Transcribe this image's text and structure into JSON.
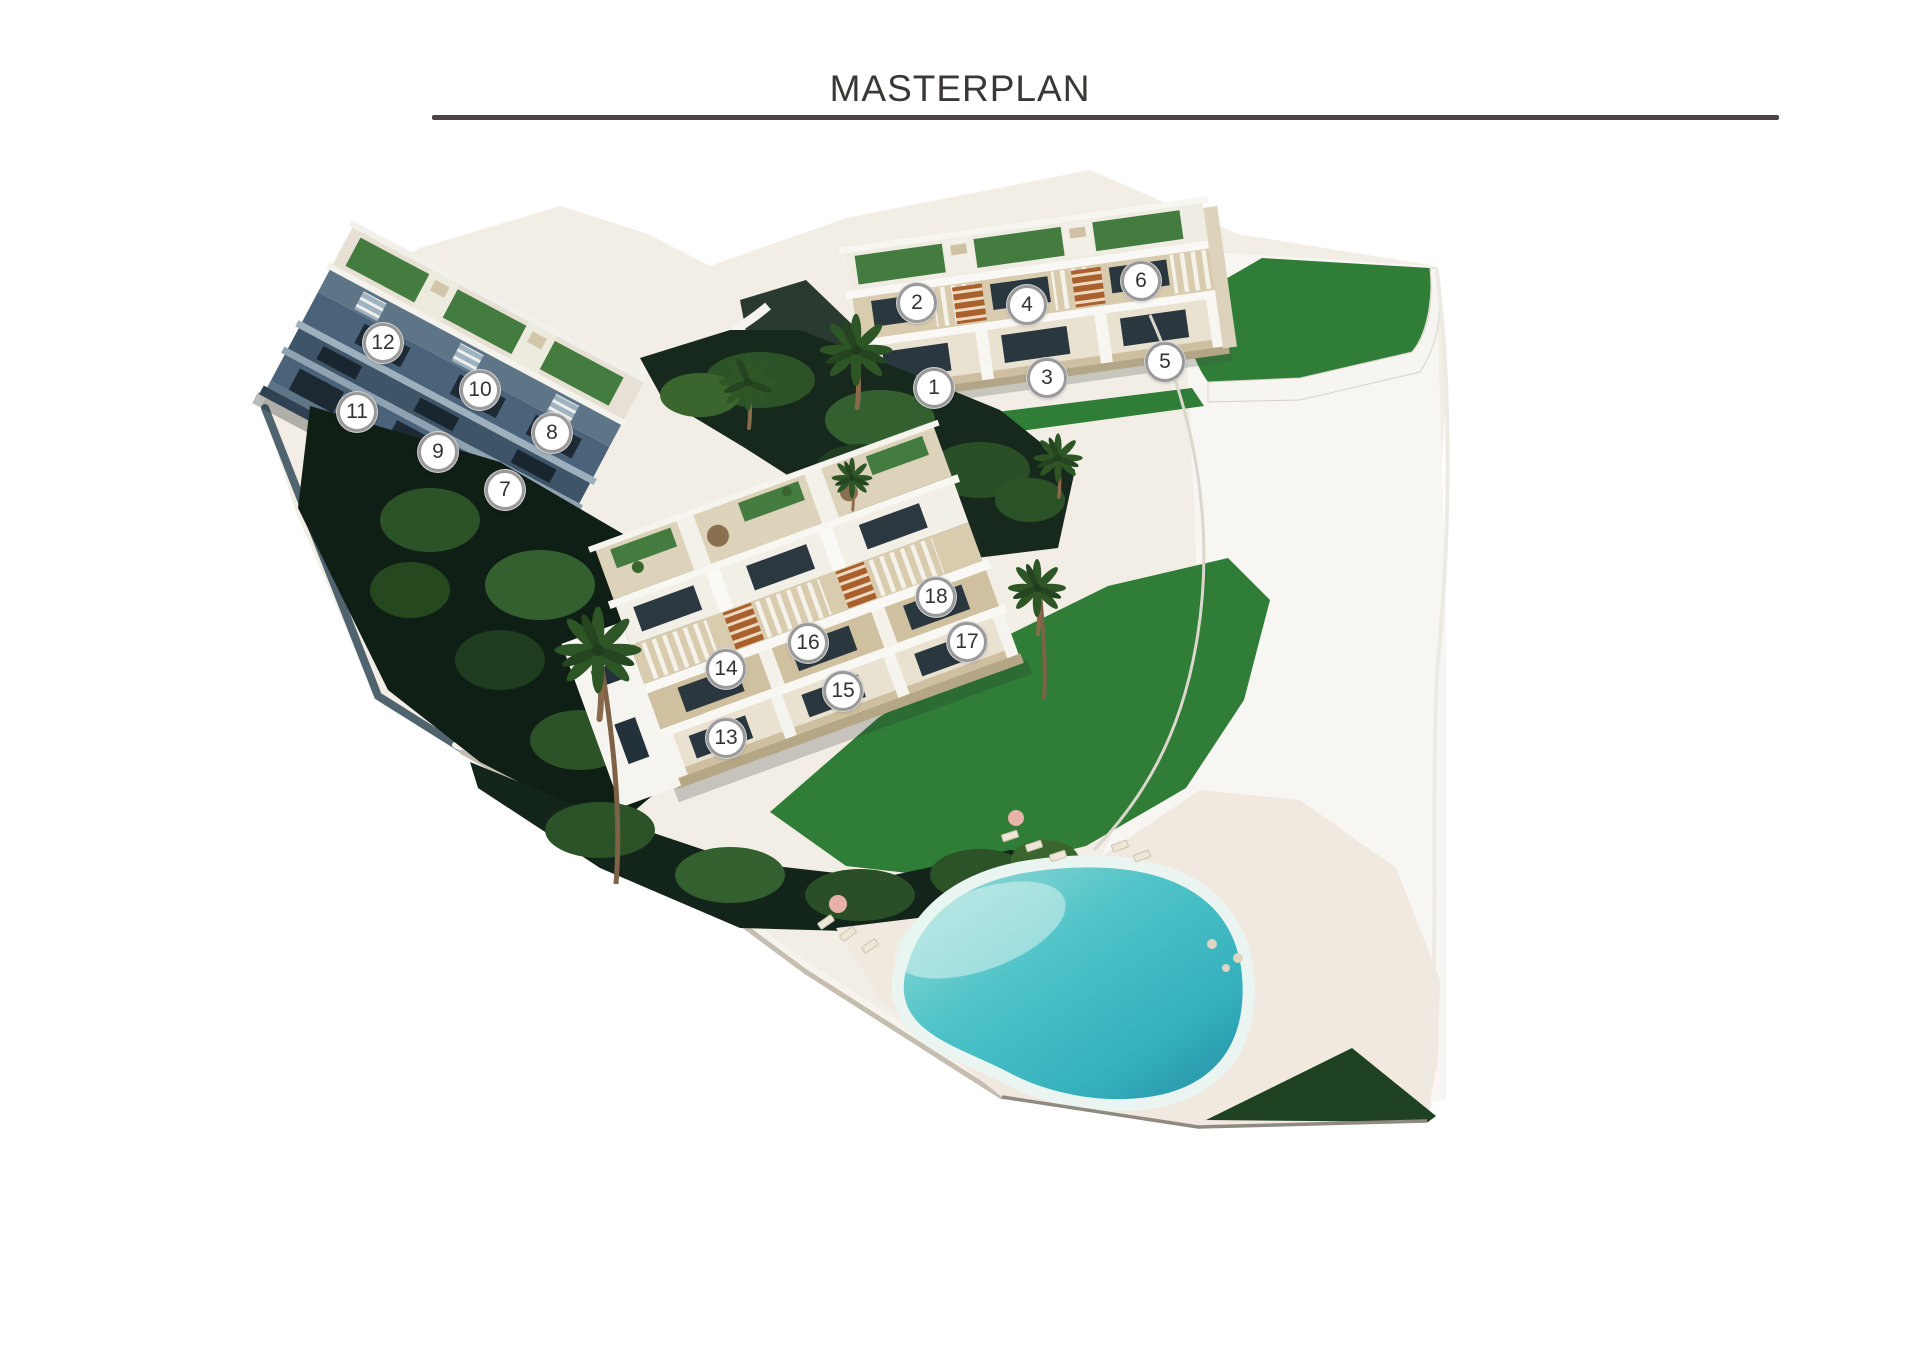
{
  "header": {
    "title": "MASTERPLAN"
  },
  "site_plan": {
    "unit_markers": [
      {
        "number": "1",
        "x": 934,
        "y": 388
      },
      {
        "number": "2",
        "x": 917,
        "y": 303
      },
      {
        "number": "3",
        "x": 1047,
        "y": 378
      },
      {
        "number": "4",
        "x": 1027,
        "y": 305
      },
      {
        "number": "5",
        "x": 1165,
        "y": 362
      },
      {
        "number": "6",
        "x": 1141,
        "y": 281
      },
      {
        "number": "7",
        "x": 505,
        "y": 490
      },
      {
        "number": "8",
        "x": 552,
        "y": 433
      },
      {
        "number": "9",
        "x": 438,
        "y": 452
      },
      {
        "number": "10",
        "x": 480,
        "y": 390
      },
      {
        "number": "11",
        "x": 357,
        "y": 412
      },
      {
        "number": "12",
        "x": 383,
        "y": 343
      },
      {
        "number": "13",
        "x": 726,
        "y": 738
      },
      {
        "number": "14",
        "x": 726,
        "y": 669
      },
      {
        "number": "15",
        "x": 843,
        "y": 691
      },
      {
        "number": "16",
        "x": 808,
        "y": 643
      },
      {
        "number": "17",
        "x": 967,
        "y": 642
      },
      {
        "number": "18",
        "x": 936,
        "y": 597
      }
    ],
    "blocks": [
      {
        "id": "block-north",
        "units": "1-6"
      },
      {
        "id": "block-west",
        "units": "7-12"
      },
      {
        "id": "block-south",
        "units": "13-18"
      }
    ],
    "amenities": [
      "communal-pool",
      "gardens",
      "lawns",
      "palm-trees"
    ]
  },
  "palette": {
    "ink": "#3b3735",
    "rule": "#4d4544",
    "ground": "#f2eee5",
    "deck": "#f1e9df",
    "terrace": "#d8cbae",
    "terrace-dark": "#cfc09f",
    "building-light": "#f2efe7",
    "facade-cream": "#eae2d1",
    "window-dark": "#2a373f",
    "blue-facade": "#4a627a",
    "blue-facade-dark": "#3e5468",
    "blue-deck": "#5d7587",
    "lawn": "#2f7d36",
    "roof-lawn": "#447b3f",
    "lawn-dark": "#1e4121",
    "foliage": "#16291c",
    "bush-light": "#3a662e",
    "bush-mid": "#2c5227",
    "pool": "#45bdc5",
    "pool-deep": "#2b9fae",
    "pool-light": "#b9e6e0",
    "stair-orange": "#a9602c",
    "trunk": "#8a6a4a",
    "marker-ring": "#999999",
    "marker-text": "#333333"
  }
}
